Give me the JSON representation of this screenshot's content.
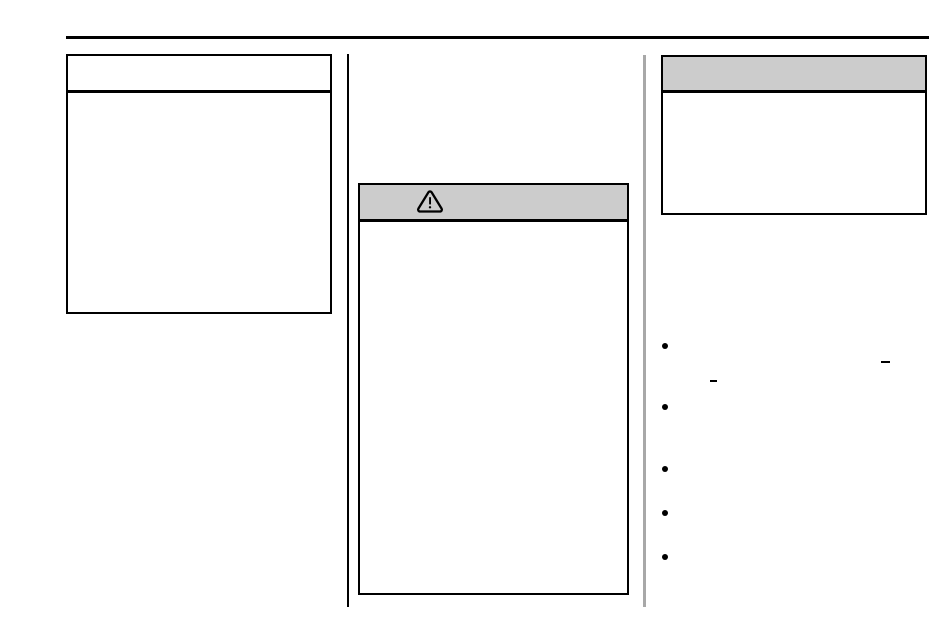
{
  "page": {
    "background_color": "#ffffff"
  },
  "top_rule": {
    "color": "#000000"
  },
  "dividers": {
    "between_left_and_middle_color": "#000000",
    "between_middle_and_right_color": "#a8a8a8"
  },
  "left_panel": {
    "header_text": "",
    "body_text": "",
    "header_fill": "#ffffff"
  },
  "caution_panel": {
    "header_icon": "warning-triangle-icon",
    "header_fill": "#cccccc",
    "header_text": "",
    "body_text": ""
  },
  "right_panel": {
    "header_fill": "#cccccc",
    "header_text": "",
    "body_text": ""
  },
  "right_column_list": {
    "marker_glyph": "●",
    "marker_color": "#000000",
    "items": [
      "",
      "",
      "",
      "",
      ""
    ],
    "dash_glyph": "–",
    "dash_count": 2
  }
}
